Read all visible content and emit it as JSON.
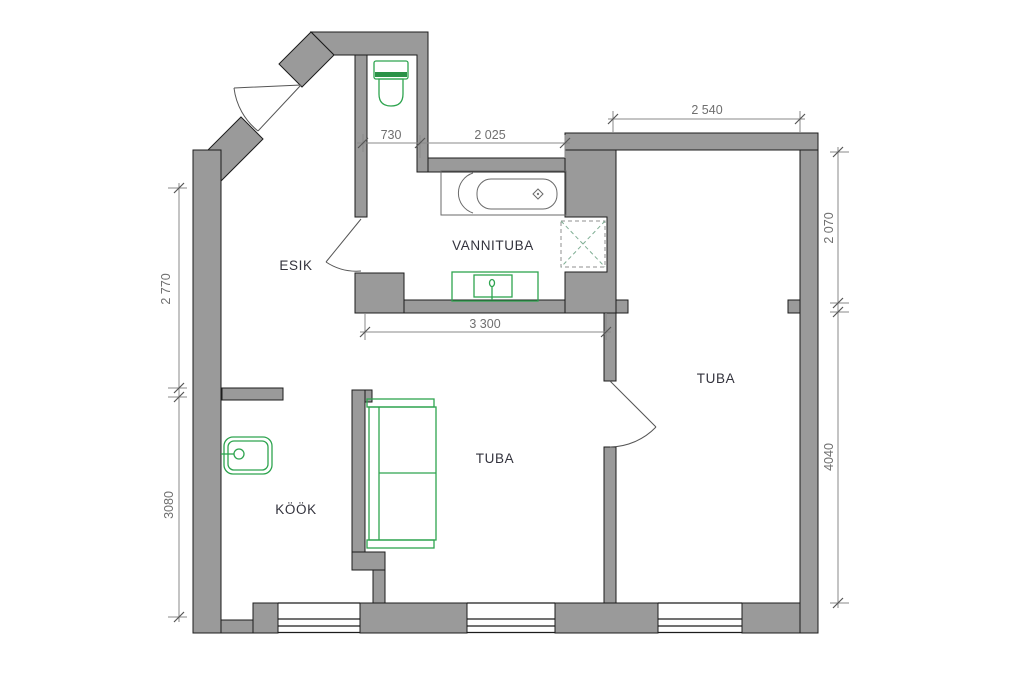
{
  "plan": {
    "type": "apartment-floor-plan",
    "rooms": [
      {
        "id": "esik",
        "label": "ESIK"
      },
      {
        "id": "vannituba",
        "label": "VANNITUBA"
      },
      {
        "id": "tuba_right",
        "label": "TUBA"
      },
      {
        "id": "tuba_middle",
        "label": "TUBA"
      },
      {
        "id": "kook",
        "label": "KÖÖK"
      }
    ],
    "dimensions_mm": {
      "wc_niche_width": "730",
      "bathroom_top_width": "2 025",
      "right_room_top_width": "2 540",
      "hall_left_height": "2 770",
      "kitchen_left_height": "3080",
      "right_room_upper_height": "2 070",
      "right_room_lower_height": "4040",
      "middle_room_width": "3 300"
    },
    "fixtures": [
      "toilet",
      "bathtub",
      "washbasin",
      "ventilation-shaft",
      "kitchen-sink",
      "sofa"
    ],
    "colors": {
      "wall": "#9a9a9a",
      "outline": "#1c1c1c",
      "green": "#2ea44f",
      "green-dark": "#2a9247",
      "dim": "#8a8a8a",
      "dimtext": "#6f6f6f",
      "label": "#33333d",
      "tub": "#6a6a6a",
      "shaft": "#7fae94",
      "door": "#555555"
    }
  }
}
